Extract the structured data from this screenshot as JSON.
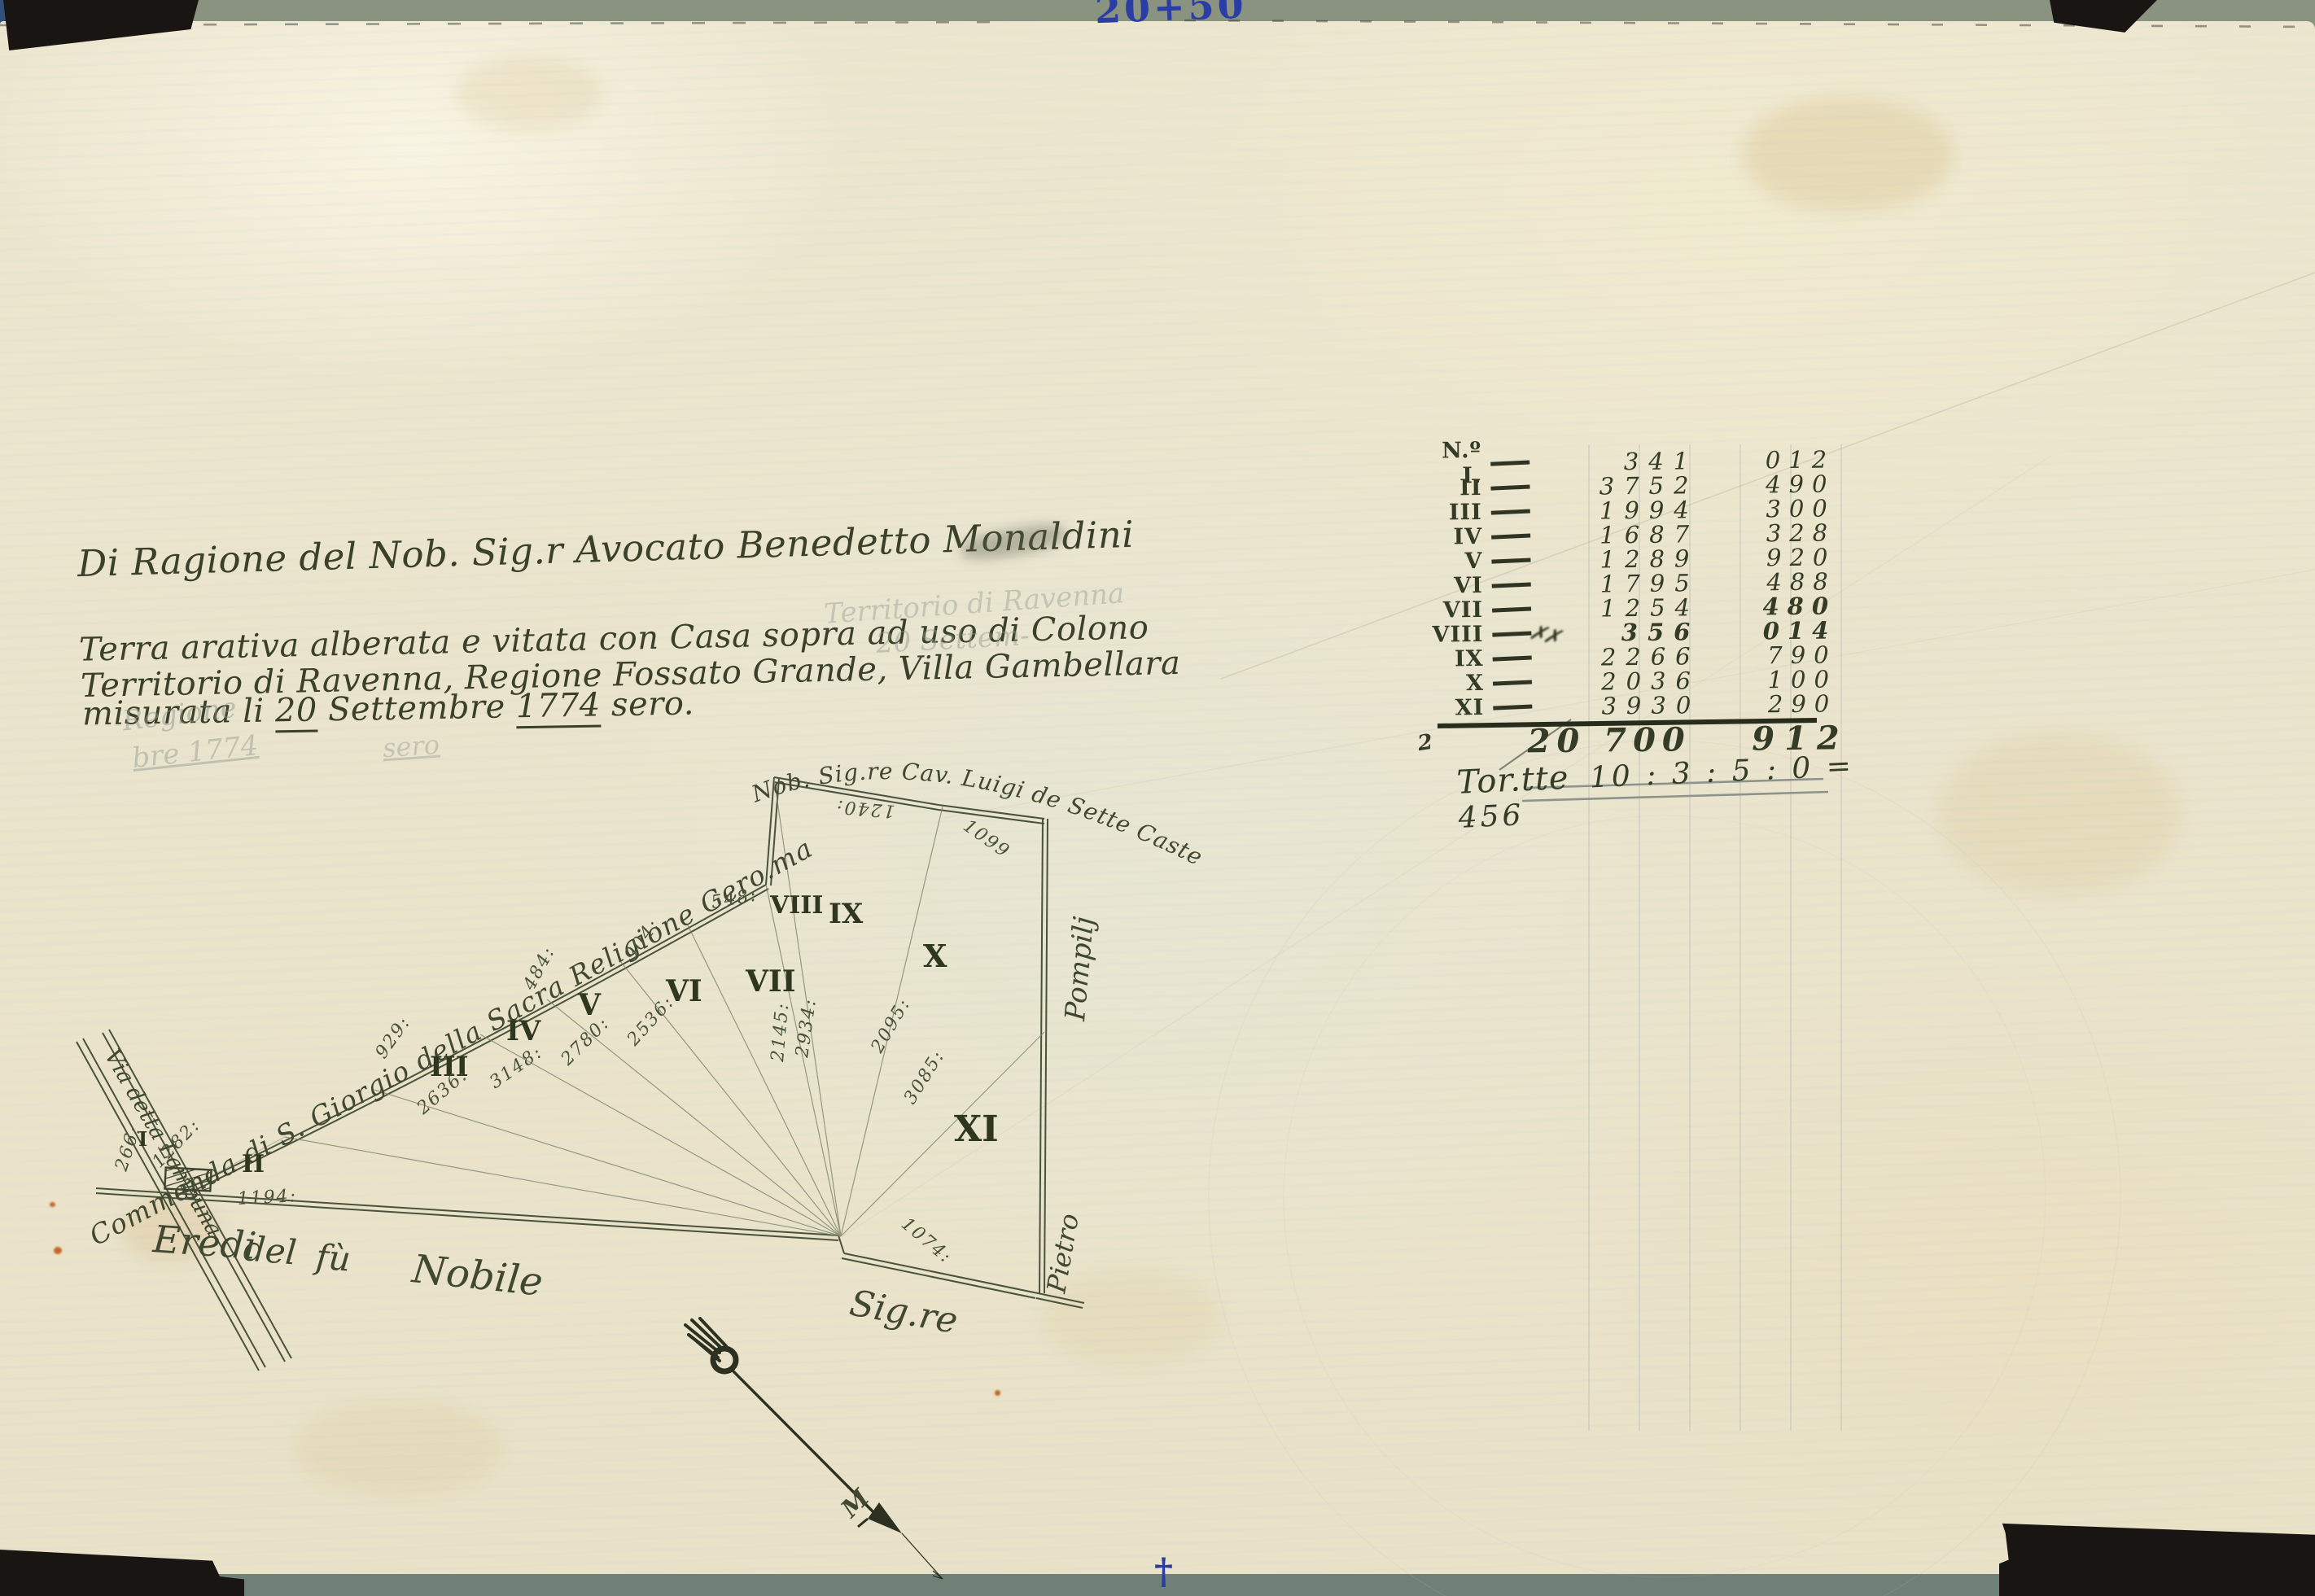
{
  "colors": {
    "ink": "#3a4029",
    "pencil": "#8d978e",
    "blue_ink": "#2a3da6",
    "paper": "#ece6cf",
    "scanner_bed": "#87907e"
  },
  "scan": {
    "top_blue_mark": "20+50",
    "bottom_blue_mark": "†"
  },
  "heading": {
    "owner_line": "Di Ragione del Nob. Sig.r Avocato Benedetto Monaldini"
  },
  "description": {
    "line1": "Terra arativa alberata e vitata con Casa sopra ad uso di Colono",
    "line2": "Territorio di Ravenna, Regione Fossato Grande, Villa Gambellara",
    "line3": [
      "misurata li ",
      "20",
      " Settembre ",
      "1774",
      " sero."
    ]
  },
  "pencil_notes": {
    "n1": "Territorio di Ravenna",
    "n2": "20 Settem-",
    "n3": "Regione",
    "n4": "bre 1774",
    "n5": "sero"
  },
  "survey_table": {
    "rows": [
      {
        "label": "N.º I.",
        "area": "341",
        "frac": "012"
      },
      {
        "label": "II",
        "area": "3752",
        "frac": "490"
      },
      {
        "label": "III",
        "area": "1994",
        "frac": "300"
      },
      {
        "label": "IV",
        "area": "1687",
        "frac": "328"
      },
      {
        "label": "V",
        "area": "1289",
        "frac": "920"
      },
      {
        "label": "VI",
        "area": "1795",
        "frac": "488"
      },
      {
        "label": "VII",
        "area": "1254",
        "frac": "480"
      },
      {
        "label": "VIII",
        "area": "356",
        "frac": "014",
        "blot": "✗✗"
      },
      {
        "label": "IX",
        "area": "2266",
        "frac": "790"
      },
      {
        "label": "X",
        "area": "2036",
        "frac": "100"
      },
      {
        "label": "XI",
        "area": "3930",
        "frac": "290"
      }
    ],
    "total": {
      "carry": "2",
      "area": "20 700",
      "frac": "912"
    },
    "conversion": {
      "label": "Tor.tte",
      "value": "10 : 3 : 5 : 0 = 456"
    }
  },
  "map": {
    "neighbors": {
      "north": "Nob. Sig.re Cav. Luigi de Sette Castelli",
      "west": "Commenda di S. Giorgio della Sacra Religione Gero.ma",
      "south": [
        "Eredi",
        "del",
        "fù",
        "Nobile"
      ],
      "south2": "Sig.re",
      "east_top": "Pompilj",
      "east_bottom": "Pietro",
      "road": "Via detta Lampuna"
    },
    "parcels": [
      "I",
      "II",
      "III",
      "IV",
      "V",
      "VI",
      "VII",
      "VIII",
      "IX",
      "X",
      "XI"
    ],
    "measurements": [
      "1282:",
      "266:",
      "1194:",
      "2636:",
      "3148:",
      "2780:",
      "2536:",
      "929:",
      "484:",
      "904:",
      "548:",
      "2145:",
      "2934:",
      "2095:",
      "3085:",
      "1240:",
      "1099",
      "1074:"
    ],
    "compass_glyph": "M"
  }
}
